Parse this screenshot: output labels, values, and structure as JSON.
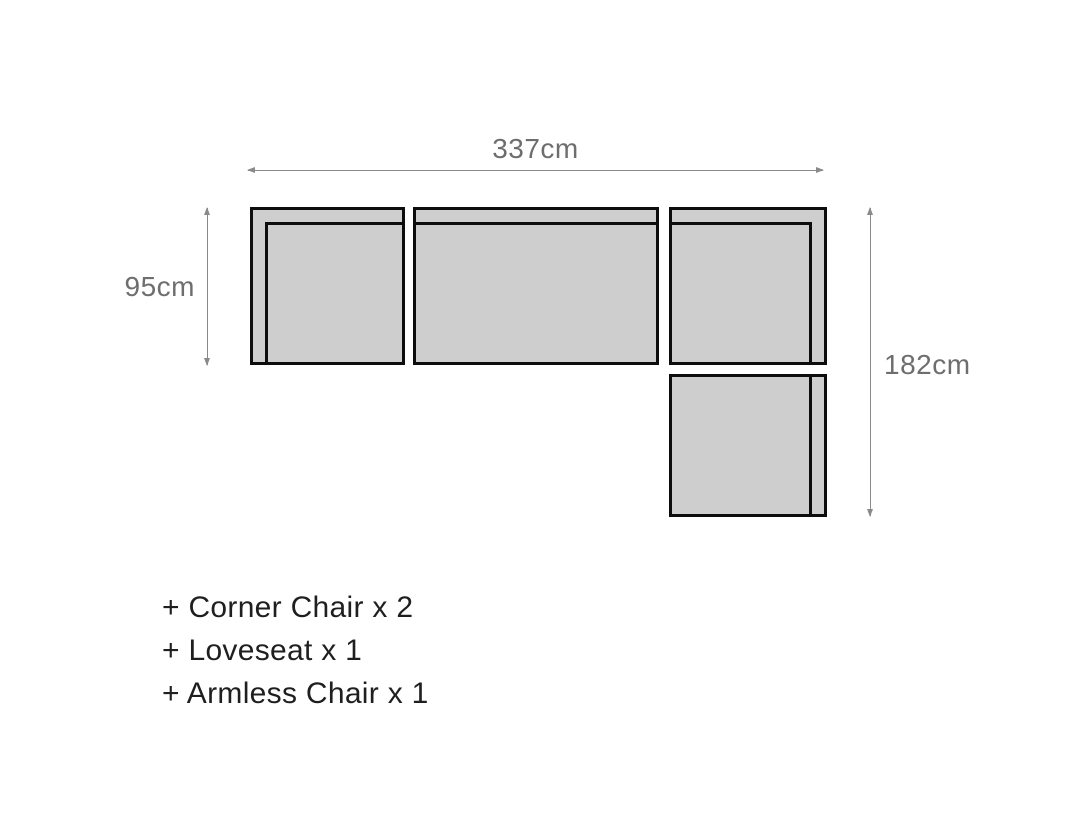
{
  "diagram": {
    "width_label": "337cm",
    "depth_label": "95cm",
    "height_label": "182cm"
  },
  "components": [
    {
      "label": "+ Corner Chair x 2"
    },
    {
      "label": "+ Loveseat x 1"
    },
    {
      "label": "+ Armless Chair x 1"
    }
  ],
  "colors": {
    "box_fill": "#cecece",
    "box_border": "#0d0d0d",
    "dim_line": "#8a8a8a",
    "dim_text": "#6e6e6e",
    "list_text": "#1f1f1f",
    "bg": "#ffffff"
  }
}
